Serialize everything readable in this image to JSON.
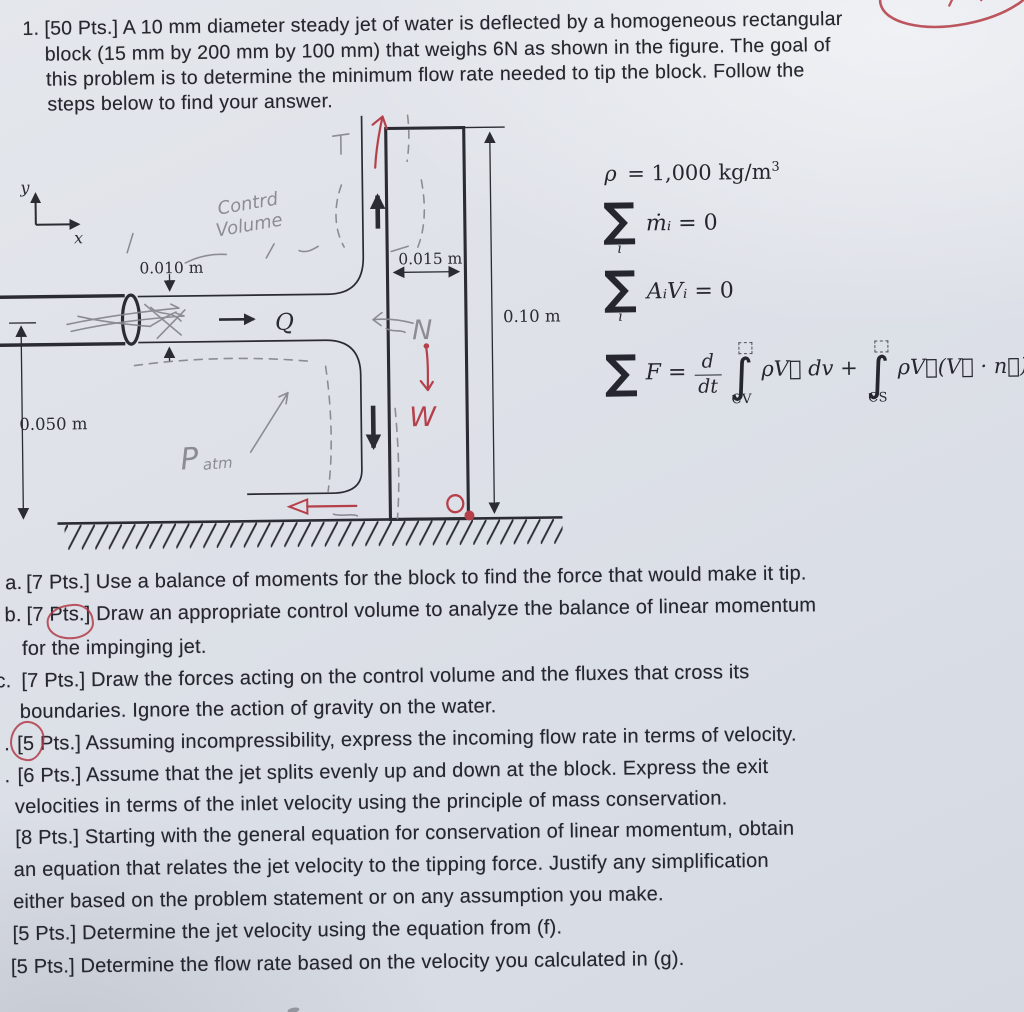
{
  "paper": {
    "problem_number": "1.",
    "statement_lines": [
      "[50 Pts.] A 10 mm diameter steady jet of water is deflected by a homogeneous rectangular",
      "block (15 mm by 200 mm by 100 mm) that weighs 6N as shown in the figure. The goal of",
      "this problem is to determine the minimum flow rate needed to tip the block. Follow the",
      "steps below to find your answer."
    ],
    "tasks": [
      {
        "marker": "a.",
        "lines": [
          "[7 Pts.] Use a balance of moments for the block to find the force that would make it tip."
        ]
      },
      {
        "marker": "b.",
        "lines": [
          "[7 Pts.] Draw an appropriate control volume to analyze the balance of linear momentum",
          "for the impinging jet."
        ]
      },
      {
        "marker": "c.",
        "lines": [
          "[7 Pts.] Draw the forces acting on the control volume and the fluxes that cross its",
          "boundaries. Ignore the action of gravity on the water."
        ]
      },
      {
        "marker": ".",
        "lines": [
          "[5 Pts.] Assuming incompressibility, express the incoming flow rate in terms of velocity."
        ]
      },
      {
        "marker": ".",
        "lines": [
          "[6 Pts.] Assume that the jet splits evenly up and down at the block. Express the exit",
          "velocities in terms of the inlet velocity using the principle of mass conservation."
        ]
      },
      {
        "marker": "",
        "lines": [
          "[8 Pts.] Starting with the general equation for conservation of linear momentum, obtain",
          "an equation that relates the jet velocity to the tipping force. Justify any simplification",
          "either based on the problem statement or on any assumption you make."
        ]
      },
      {
        "marker": "",
        "lines": [
          "[5 Pts.] Determine the jet velocity using the equation from (f)."
        ]
      },
      {
        "marker": "",
        "lines": [
          "[5 Pts.] Determine the flow rate based on the velocity you calculated in (g)."
        ]
      }
    ]
  },
  "figure": {
    "axis_y_label": "y",
    "axis_x_label": "x",
    "jet_diameter_label": "0.010 m",
    "block_width_label": "0.015 m",
    "block_height_label": "0.10 m",
    "jet_height_label": "0.050 m",
    "flow_label": "Q",
    "handwritten": {
      "control_volume_line1": "Contrd",
      "control_volume_line2": "Volume",
      "normal_force": "N",
      "weight": "W",
      "pressure_main": "P",
      "pressure_sub": "atm"
    }
  },
  "equations": {
    "density": {
      "symbol": "ρ",
      "relation": "= 1,000 kg/m",
      "exponent": "3"
    },
    "mass_balance": {
      "sigma": "∑",
      "index": "i",
      "term": "ṁᵢ",
      "rhs": "= 0"
    },
    "volume_balance": {
      "sigma": "∑",
      "index": "i",
      "term": "AᵢVᵢ",
      "rhs": "= 0"
    },
    "momentum": {
      "sigma": "∑",
      "lhs": "F =",
      "frac_num": "d",
      "frac_den": "dt",
      "integral1": "∫",
      "integral1_sub": "CV",
      "body1": "ρV⃗ dv +",
      "integral2": "∫",
      "integral2_sub": "CS",
      "body2": "ρV⃗(V⃗ · n⃗) da"
    }
  },
  "colors": {
    "red_pen": "#b5404a",
    "pencil": "#85868c",
    "ink": "#26262e",
    "paper": "#dde0e7"
  }
}
